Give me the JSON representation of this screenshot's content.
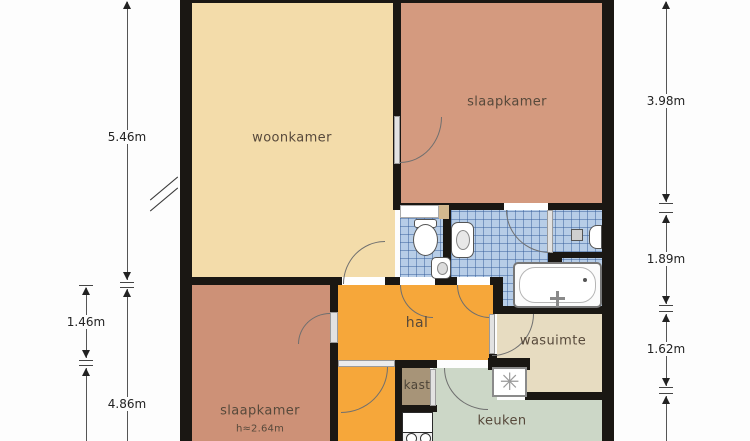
{
  "title": "floor plan",
  "rooms": {
    "woonkamer": "woonkamer",
    "slaapkamer_top": "slaapkamer",
    "slaapkamer_bottom": "slaapkamer",
    "slaapkamer_bottom_height": "h≈2.64m",
    "hal": "hal",
    "kast": "kast",
    "keuken": "keuken",
    "wasuimte": "wasuimte"
  },
  "dimensions": {
    "left_main": [
      "5.46m",
      "4.86m"
    ],
    "left_secondary": [
      "1.46m"
    ],
    "right": [
      "3.98m",
      "1.89m",
      "1.62m"
    ]
  },
  "symbols": {
    "washer": "✳"
  },
  "colors": {
    "woonkamer": "#f3dcaa",
    "slaapkamer_top": "#d49a7f",
    "slaapkamer_bottom": "#cd9177",
    "hal": "#f6a73a",
    "kast": "#a79478",
    "keuken": "#ccd7c7",
    "wasuimte": "#e7dcc1",
    "bathroom_tiles": "#b7cde7",
    "walls": "#1a1713"
  }
}
